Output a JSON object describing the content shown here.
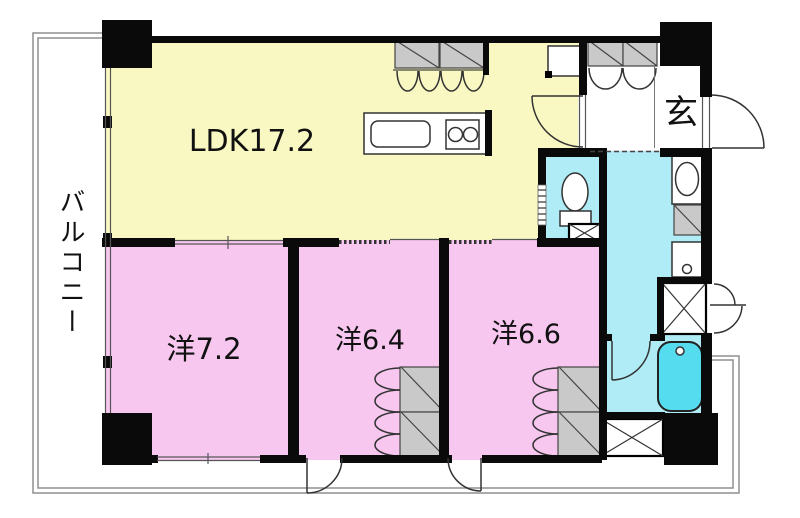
{
  "plan": {
    "type": "floor-plan",
    "labels": {
      "ldk": "LDK17.2",
      "bedroom1": "洋7.2",
      "bedroom2": "洋6.4",
      "bedroom3": "洋6.6",
      "entrance": "玄",
      "balcony": "バルコニー"
    },
    "colors": {
      "ldk": "#FAF8C2",
      "bedroom": "#F8C7F0",
      "wet": "#B0ECF6",
      "bathtub": "#55DCEE",
      "closet": "#C9C9C9",
      "hall": "#FFFFFF",
      "wall": "#0A0A0A"
    }
  }
}
